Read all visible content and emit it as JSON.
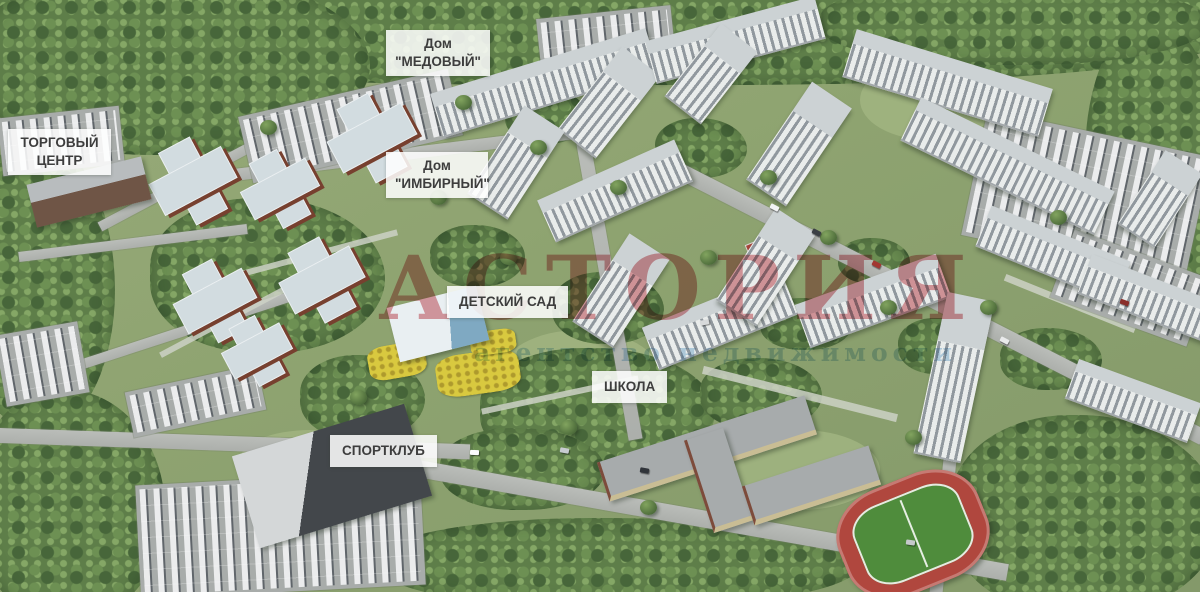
{
  "labels": {
    "shopping_center": {
      "line1": "ТОРГОВЫЙ",
      "line2": "ЦЕНТР"
    },
    "house_medovy": {
      "line1": "Дом",
      "line2": "\"МЕДОВЫЙ\""
    },
    "house_imbirny": {
      "line1": "Дом",
      "line2": "\"ИМБИРНЫЙ\""
    },
    "kindergarten": {
      "text": "ДЕТСКИЙ САД"
    },
    "school": {
      "text": "ШКОЛА"
    },
    "sport_club": {
      "text": "СПОРТКЛУБ"
    }
  },
  "watermark": {
    "title": "АСТОРИЯ",
    "subtitle": "агентство недвижимости"
  },
  "colors": {
    "watermark_red": "#ba1824",
    "watermark_blue": "#88b8da",
    "label_bg": "rgba(255,255,255,0.86)",
    "label_text": "#3d3d3d",
    "track_red": "#b0473e",
    "field_green": "#4f8c3c"
  }
}
